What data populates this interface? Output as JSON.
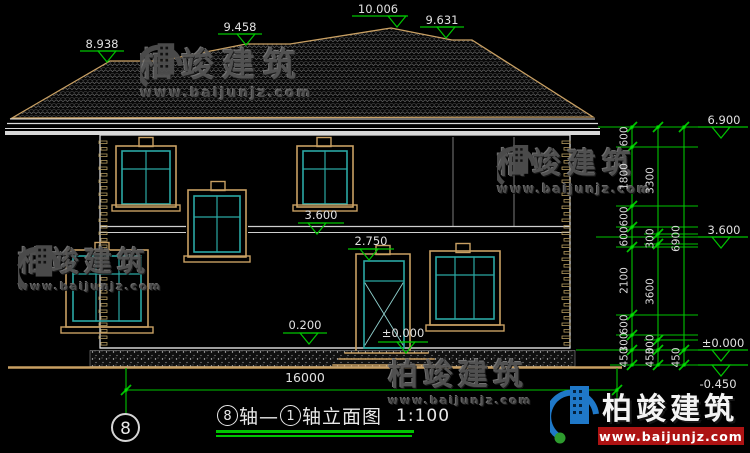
{
  "drawing": {
    "top_markers": [
      {
        "label": "8.938"
      },
      {
        "label": "9.458"
      },
      {
        "label": "10.006"
      },
      {
        "label": "9.631"
      }
    ],
    "right_markers": [
      {
        "label": "6.900"
      },
      {
        "label": "3.600"
      },
      {
        "label": "±0.000"
      },
      {
        "label": "-0.450"
      }
    ],
    "inner_markers": [
      {
        "label": "3.600"
      },
      {
        "label": "2.750"
      },
      {
        "label": "0.200"
      },
      {
        "label": "±0.000"
      }
    ],
    "chains": {
      "inner": [
        "600",
        "1800",
        "600",
        "600",
        "2100",
        "600",
        "300",
        "450"
      ],
      "middle": [
        "3300",
        "300",
        "3600",
        "300",
        "450"
      ],
      "outer": [
        "6900",
        "450"
      ]
    },
    "overall_width_label": "16000",
    "axis_bubble_label": "8"
  },
  "title_block": {
    "axis_start": "8",
    "joiner": "轴—",
    "axis_end": "1",
    "suffix": "轴立面图",
    "scale": "1:100"
  },
  "watermark": {
    "brand": "柏竣建筑",
    "url": "www.baijunjz.com"
  },
  "colors": {
    "dim_green": "#00c400",
    "line_white": "#d8d8d8",
    "frame_tan": "#c9a063",
    "glass_cyan": "#2aa8a4",
    "logo_blue": "#1f78c8",
    "logo_red": "#ad1313"
  }
}
